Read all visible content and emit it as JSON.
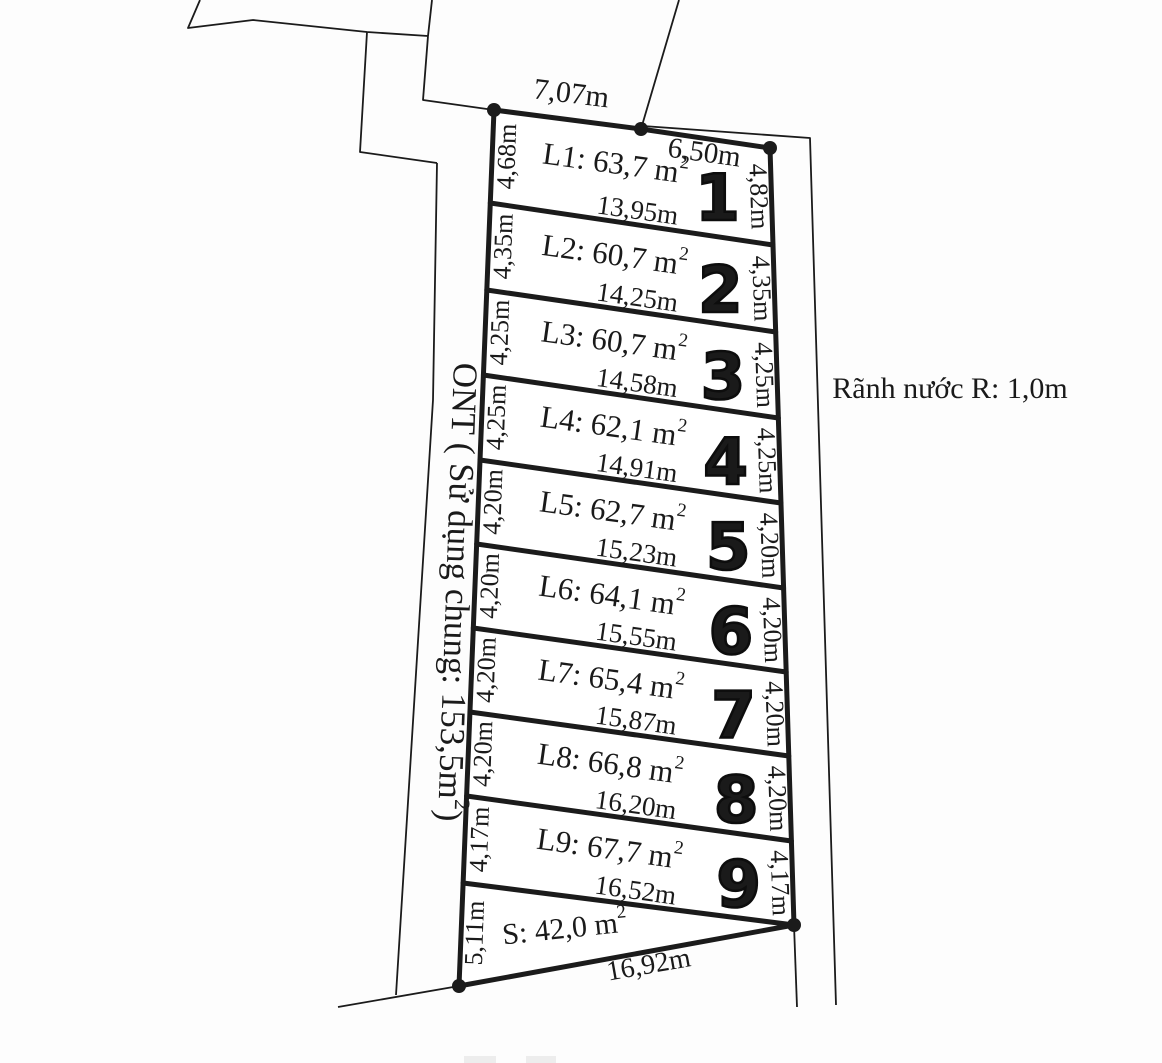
{
  "diagram": {
    "title_hint": "Land subdivision survey sketch",
    "colors": {
      "background": "#fdfdfd",
      "line": "#1b1b1b",
      "text": "#1a1a1a",
      "number": "#0d0d0d",
      "faint_fragment": "#ededed"
    },
    "top_widths": [
      {
        "label": "7,07m"
      },
      {
        "label": "6,50m"
      }
    ],
    "lots": [
      {
        "number": "1",
        "area_prefix": "L1: 63,7 m",
        "area_sup": "2",
        "left": "4,68m",
        "right": "4,82m",
        "width": "13,95m"
      },
      {
        "number": "2",
        "area_prefix": "L2: 60,7 m",
        "area_sup": "2",
        "left": "4,35m",
        "right": "4,35m",
        "width": "14,25m"
      },
      {
        "number": "3",
        "area_prefix": "L3: 60,7 m",
        "area_sup": "2",
        "left": "4,25m",
        "right": "4,25m",
        "width": "14,58m"
      },
      {
        "number": "4",
        "area_prefix": "L4: 62,1 m",
        "area_sup": "2",
        "left": "4,25m",
        "right": "4,25m",
        "width": "14,91m"
      },
      {
        "number": "5",
        "area_prefix": "L5: 62,7 m",
        "area_sup": "2",
        "left": "4,20m",
        "right": "4,20m",
        "width": "15,23m"
      },
      {
        "number": "6",
        "area_prefix": "L6: 64,1 m",
        "area_sup": "2",
        "left": "4,20m",
        "right": "4,20m",
        "width": "15,55m"
      },
      {
        "number": "7",
        "area_prefix": "L7: 65,4 m",
        "area_sup": "2",
        "left": "4,20m",
        "right": "4,20m",
        "width": "15,87m"
      },
      {
        "number": "8",
        "area_prefix": "L8: 66,8 m",
        "area_sup": "2",
        "left": "4,20m",
        "right": "4,20m",
        "width": "16,20m"
      },
      {
        "number": "9",
        "area_prefix": "L9: 67,7 m",
        "area_sup": "2",
        "left": "4,17m",
        "right": "4,17m",
        "width": "16,52m"
      }
    ],
    "s_lot": {
      "area_prefix": "S: 42,0 m",
      "area_sup": "2",
      "left": "5,11m",
      "width": "16,92m"
    },
    "right_note": "Rãnh nước R: 1,0m",
    "left_note": {
      "prefix": "ONT ( Sử dụng chung: 153,5m",
      "sup": "2",
      "suffix": ")"
    }
  }
}
